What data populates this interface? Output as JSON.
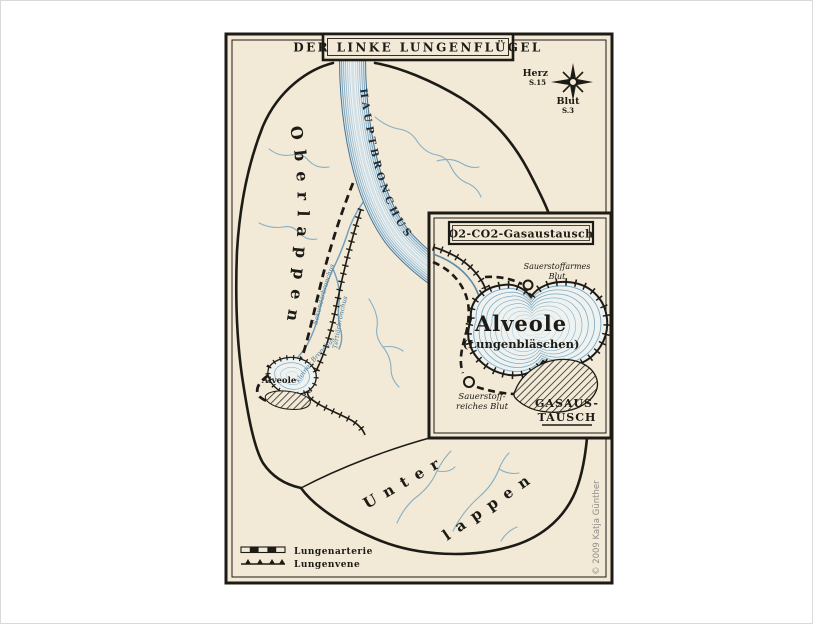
{
  "colors": {
    "paper": "#f2e9d6",
    "ink": "#1d1b16",
    "river_edge": "#4a7390",
    "stream_blue": "#86afc4",
    "lake_contour": "#7fa9bf",
    "credit_gray": "#8f8e88"
  },
  "banner": {
    "title": "DER LINKE LUNGENFLÜGEL"
  },
  "compass": {
    "west_label": "Herz",
    "west_page": "S.15",
    "south_label": "Blut",
    "south_page": "S.3"
  },
  "regions": {
    "upper": "Oberlappen",
    "lower_line1": "Unter-",
    "lower_line2": "lappen"
  },
  "bronchi": {
    "main": "HAUPTBRONCHUS",
    "secondary": "Sekundärbronchus",
    "tertiary": "Tertiärbronchus",
    "small": "kleiner Bronchus"
  },
  "alveole_small_label": "Alveole",
  "inset": {
    "title": "O2-CO2-Gasaustausch",
    "lake_name": "Alveole",
    "lake_sub": "(Lungenbläschen)",
    "top_marker_line1": "Sauerstoffarmes",
    "top_marker_line2": "Blut",
    "bottom_marker_line1": "Sauerstoff-",
    "bottom_marker_line2": "reiches Blut",
    "exchange_line1": "GASAUS-",
    "exchange_line2": "TAUSCH"
  },
  "legend": {
    "artery": "Lungenarterie",
    "vein": "Lungenvene"
  },
  "credit": "© 2009 Katja Günther"
}
